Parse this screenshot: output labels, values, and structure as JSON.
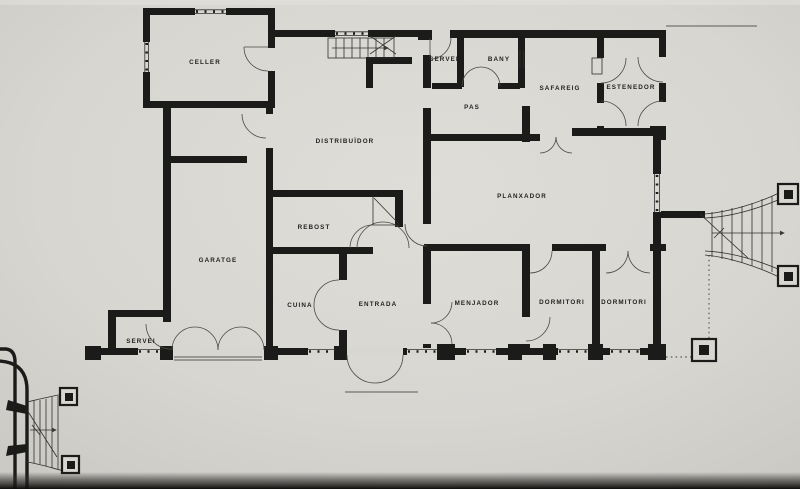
{
  "document": {
    "kind": "photographed architectural floor plan drawing",
    "language": "Catalan"
  },
  "colors": {
    "paper": "#d8d6d1",
    "paper_light": "#dedcd7",
    "paper_shade": "#c7c5c0",
    "ink": "#1b1b1a",
    "photo_edge_dark": "#0d0d0c"
  },
  "rooms": [
    {
      "id": "celler",
      "label": "CELLER"
    },
    {
      "id": "servei-top",
      "label": "SERVEI"
    },
    {
      "id": "bany",
      "label": "BANY"
    },
    {
      "id": "safareig",
      "label": "SAFAREIG"
    },
    {
      "id": "estenedor",
      "label": "ESTENEDOR"
    },
    {
      "id": "pas",
      "label": "PAS"
    },
    {
      "id": "distribuidor",
      "label": "DISTRIBUÏDOR"
    },
    {
      "id": "planxador",
      "label": "PLANXADOR"
    },
    {
      "id": "rebost",
      "label": "REBOST"
    },
    {
      "id": "garatge",
      "label": "GARATGE"
    },
    {
      "id": "cuina",
      "label": "CUINA"
    },
    {
      "id": "entrada",
      "label": "ENTRADA"
    },
    {
      "id": "menjador",
      "label": "MENJADOR"
    },
    {
      "id": "dormitori-1",
      "label": "DORMITORI"
    },
    {
      "id": "dormitori-2",
      "label": "DORMITORI"
    },
    {
      "id": "servei-bottom",
      "label": "SERVEI"
    }
  ],
  "features": [
    {
      "id": "interior-staircase",
      "name": "interior stair with direction cross"
    },
    {
      "id": "exterior-stair-right",
      "name": "flared exterior stair with pillars (east)"
    },
    {
      "id": "exterior-stair-left",
      "name": "flared exterior stair with pillars at driveway (south-west)"
    },
    {
      "id": "driveway-curb",
      "name": "curved driveway curb lines"
    },
    {
      "id": "garage-doors",
      "name": "double garage door swing"
    },
    {
      "id": "front-door",
      "name": "main entrance door swing"
    },
    {
      "id": "setback-line",
      "name": "dotted property/setback line with corner pillar"
    }
  ]
}
